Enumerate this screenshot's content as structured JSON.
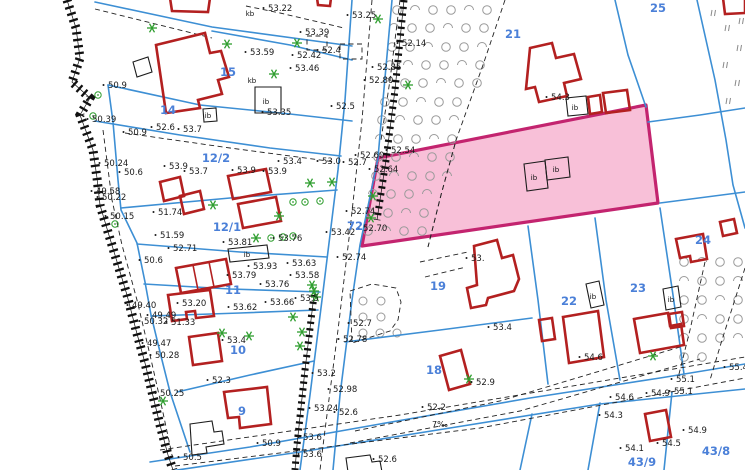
{
  "map": {
    "colors": {
      "background": "#ffffff",
      "boundary": "#3d8fd4",
      "building": "#b32020",
      "black_building": "#1c1c1c",
      "highlight_fill": "#f8bdd6",
      "highlight_border": "#c3246f",
      "parcel_label": "#4b80d8",
      "highlight_label": "#6f74d8",
      "elevation": "#1a1a1a",
      "tree": "#2f9e2f",
      "orchard": "#9a9a9a",
      "meadow": "#8a8a8a",
      "dash": "#222222"
    },
    "highlight_parcel": {
      "number": "20",
      "polygon": "M378,158 L646,105 L658,203 L362,246 Z",
      "inner_dash": "M455,144 L441,195 L428,247"
    },
    "blue_lines": [
      "M95,2 L212,27 L352,46",
      "M212,31 L290,45 L352,60",
      "M108,85 L200,105 L290,114 L352,121",
      "M95,121 L180,135 L270,148 L341,156",
      "M108,85 L113,122 L118,180 L121,210 L137,243 L145,282 L151,315 L160,352 L170,392 L182,428 L190,452",
      "M121,208 L230,198 L337,190",
      "M137,244 L240,252 L327,257",
      "M144,284 L230,289 L320,292",
      "M151,316 L240,313 L318,310",
      "M177,392 L250,375 L314,361",
      "M352,0 L345,100 L338,170 L330,235 L322,300 L310,395 L300,470",
      "M392,0 L383,100 L378,158 L360,245 L352,300 L340,395 L333,470",
      "M615,0 L628,55 L646,107",
      "M697,0 L715,80 L726,140 L733,185 L745,228",
      "M648,122 L700,115 L745,108",
      "M528,226 L538,300 L548,384",
      "M595,218 L606,300 L620,380",
      "M660,208 L673,295 L684,374",
      "M660,203 L745,192",
      "M345,342 L440,330 L532,318",
      "M150,462 L250,447 L380,424 L530,398 L660,378 L745,364",
      "M150,474 L300,452 L450,428 L600,404 L745,389",
      "M600,403 L588,470",
      "M672,392 L664,470",
      "M532,414 L520,470"
    ],
    "dashed_lines": [
      "M246,6 L280,13 L344,28",
      "M95,9 L212,38",
      "M125,133 L230,148 L335,162",
      "M350,291 L372,284 L396,288 L401,302 L398,320 L390,331 L352,343 Z",
      "M455,144 L441,195 L428,247",
      "M160,450 L400,415 L745,357",
      "M175,466 L480,428 L745,378",
      "M355,431 L500,401 L680,347",
      "M350,443 L520,411 L700,359",
      "M705,262 L690,330 L678,378",
      "M745,268 L722,340 L710,380",
      "M420,262 L468,252",
      "M425,277 L466,267",
      "M103,130 L112,200 L122,245 L137,300 L150,355 L162,408 L172,455",
      "M372,0 L362,120 L350,230 L338,330 L325,430 L320,470",
      "M400,0 L390,80 L381,140",
      "M307,36 L327,36 L327,50 L307,50 Z",
      "M340,44 L362,44 L362,59 L340,59 Z",
      "M505,0 L483,65 L455,143"
    ],
    "hatch_bands": [
      {
        "d": "M67,0 L76,28 L80,58 L72,82 L90,98 L80,115 L93,150 L97,178 L100,205 L108,232 L118,265 L127,295 L136,330 L145,363 L152,392 L160,425 L168,455 L173,470",
        "w": 9
      },
      {
        "d": "M404,0 L395,90 L386,160 L377,220",
        "w": 7
      },
      {
        "d": "M314,295 L305,370 L297,445 L295,470",
        "w": 7
      }
    ],
    "red_buildings": [
      "M170,-2 L210,-2 L208,12 L172,11 Z",
      "M317,-2 L331,-2 L330,6 L318,5 Z",
      "M156,45 L205,33 L210,53 L221,51 L229,77 L218,80 L222,94 L198,100 L200,108 L166,113 Z",
      "M228,176 L266,169 L271,192 L233,199 Z",
      "M238,204 L276,197 L281,221 L243,228 Z",
      "M160,182 L180,177 L184,196 L164,201 Z",
      "M180,196 L200,191 L204,209 L184,214 Z",
      "M176,268 L226,259 L231,284 L181,293 Z",
      "M168,295 L210,290 L214,316 L196,318 L195,311 L186,312 L187,319 L172,321 Z",
      "M189,337 L218,333 L222,361 L193,365 Z",
      "M224,392 L267,387 L271,424 L240,428 L239,417 L228,418 Z",
      "M440,356 L461,350 L470,384 L449,390 Z",
      "M474,246 L497,240 L502,258 L513,255 L519,279 L514,291 L488,298 L486,305 L471,308 L467,288 L477,285 Z",
      "M563,317 L598,311 L604,357 L569,363 Z",
      "M539,320 L552,318 L555,339 L542,341 Z",
      "M634,319 L668,313 L670,326 L681,324 L684,345 L640,353 Z",
      "M669,314 L682,312 L684,326 L671,328 Z",
      "M676,239 L703,234 L707,259 L691,262 L690,256 L680,258 Z",
      "M720,222 L734,219 L737,233 L723,236 Z",
      "M530,48 L552,43 L556,58 L574,54 L581,79 L564,83 L567,96 L539,102 L535,87 L526,89 Z",
      "M588,97 L600,95 L602,112 L590,114 Z",
      "M603,93 L627,90 L630,110 L606,113 Z",
      "M723,-2 L745,-2 L745,13 L725,14 Z",
      "M645,414 L666,410 L671,437 L650,441 Z"
    ],
    "red_inner_lines": [
      "M193,265 L198,290",
      "M209,262 L214,287"
    ],
    "black_buildings": [
      "M133,62 L148,57 L152,72 L137,77 Z",
      "M255,87 L281,87 L281,113 L255,113 Z",
      "M203,109 L216,108 L217,121 L204,122 Z",
      "M228,249 L267,245 L269,258 L230,262 Z",
      "M586,284 L599,281 L604,305 L591,308 Z",
      "M663,289 L678,286 L681,307 L666,310 Z",
      "M524,164 L545,161 L548,188 L527,191 Z",
      "M545,160 L568,157 L570,177 L547,180 Z",
      "M566,98 L586,96 L588,114 L568,116 Z",
      "M190,424 L212,421 L214,432 L222,431 L224,444 L206,447 L207,453 L192,455 Z",
      "M346,458 L370,455 L372,462 L380,461 L382,472 L348,472 Z"
    ],
    "parcel_numbers": [
      [
        228,
        76,
        "15"
      ],
      [
        168,
        114,
        "14"
      ],
      [
        216,
        162,
        "12/2"
      ],
      [
        227,
        231,
        "12/1"
      ],
      [
        233,
        294,
        "11"
      ],
      [
        238,
        354,
        "10"
      ],
      [
        242,
        415,
        "9"
      ],
      [
        513,
        38,
        "21"
      ],
      [
        658,
        12,
        "25"
      ],
      [
        355,
        230,
        "72"
      ],
      [
        438,
        290,
        "19"
      ],
      [
        434,
        374,
        "18"
      ],
      [
        569,
        305,
        "22"
      ],
      [
        638,
        292,
        "23"
      ],
      [
        703,
        244,
        "24"
      ],
      [
        716,
        455,
        "43/8"
      ],
      [
        642,
        466,
        "43/9"
      ]
    ],
    "elevations": [
      [
        108,
        85,
        "50.9"
      ],
      [
        92,
        119,
        "50.39"
      ],
      [
        128,
        132,
        "50.9"
      ],
      [
        156,
        127,
        "52.6"
      ],
      [
        183,
        129,
        "53.7"
      ],
      [
        250,
        52,
        "53.59"
      ],
      [
        267,
        112,
        "53.35"
      ],
      [
        268,
        8,
        "53.22"
      ],
      [
        352,
        15,
        "53.25"
      ],
      [
        305,
        32,
        "53.39"
      ],
      [
        297,
        55,
        "52.42"
      ],
      [
        322,
        50,
        "52.4"
      ],
      [
        295,
        68,
        "53.46"
      ],
      [
        377,
        67,
        "52.85"
      ],
      [
        369,
        80,
        "52.80"
      ],
      [
        336,
        106,
        "52.5"
      ],
      [
        402,
        43,
        "52.14"
      ],
      [
        391,
        150,
        "52.54"
      ],
      [
        360,
        155,
        "52.60"
      ],
      [
        374,
        169,
        "52.64"
      ],
      [
        104,
        163,
        "50.24"
      ],
      [
        124,
        172,
        "50.6"
      ],
      [
        96,
        191,
        "49.58"
      ],
      [
        102,
        197,
        "50.22"
      ],
      [
        110,
        216,
        "50.15"
      ],
      [
        144,
        260,
        "50.6"
      ],
      [
        158,
        212,
        "51.74"
      ],
      [
        160,
        235,
        "51.59"
      ],
      [
        173,
        248,
        "52.71"
      ],
      [
        169,
        166,
        "53.9"
      ],
      [
        189,
        171,
        "53.7"
      ],
      [
        237,
        170,
        "53.9"
      ],
      [
        268,
        171,
        "53.9"
      ],
      [
        283,
        161,
        "53.4"
      ],
      [
        322,
        161,
        "53.0"
      ],
      [
        348,
        162,
        "52.7"
      ],
      [
        228,
        242,
        "53.81"
      ],
      [
        278,
        238,
        "53.76"
      ],
      [
        253,
        266,
        "53.93"
      ],
      [
        232,
        275,
        "53.79"
      ],
      [
        292,
        263,
        "53.63"
      ],
      [
        295,
        275,
        "53.58"
      ],
      [
        265,
        284,
        "53.76"
      ],
      [
        351,
        211,
        "52.74"
      ],
      [
        363,
        228,
        "52.70"
      ],
      [
        331,
        232,
        "53.42"
      ],
      [
        342,
        257,
        "52.74"
      ],
      [
        182,
        303,
        "53.20"
      ],
      [
        233,
        307,
        "53.62"
      ],
      [
        270,
        302,
        "53.66"
      ],
      [
        300,
        298,
        "53.5"
      ],
      [
        227,
        340,
        "53.4"
      ],
      [
        212,
        380,
        "52.3"
      ],
      [
        132,
        305,
        "49.40"
      ],
      [
        144,
        321,
        "50.32"
      ],
      [
        152,
        315,
        "49.49"
      ],
      [
        171,
        322,
        "51.33"
      ],
      [
        147,
        343,
        "49.47"
      ],
      [
        155,
        355,
        "50.28"
      ],
      [
        160,
        393,
        "50.25"
      ],
      [
        317,
        373,
        "53.2"
      ],
      [
        333,
        389,
        "52.98"
      ],
      [
        314,
        408,
        "53.24"
      ],
      [
        339,
        412,
        "52.6"
      ],
      [
        303,
        437,
        "53.6"
      ],
      [
        303,
        454,
        "53.6"
      ],
      [
        183,
        457,
        "50.5"
      ],
      [
        262,
        443,
        "50.9"
      ],
      [
        353,
        323,
        "52.7"
      ],
      [
        343,
        339,
        "52.78"
      ],
      [
        493,
        327,
        "53.4"
      ],
      [
        476,
        382,
        "52.9"
      ],
      [
        427,
        407,
        "52.2"
      ],
      [
        378,
        459,
        "52.6"
      ],
      [
        551,
        97,
        "54.3"
      ],
      [
        584,
        357,
        "54.6"
      ],
      [
        471,
        258,
        "53."
      ],
      [
        729,
        367,
        "55.4"
      ],
      [
        676,
        379,
        "55.1"
      ],
      [
        674,
        391,
        "55.1"
      ],
      [
        651,
        393,
        "54.9"
      ],
      [
        615,
        397,
        "54.6"
      ],
      [
        604,
        415,
        "54.3"
      ],
      [
        625,
        448,
        "54.1"
      ],
      [
        662,
        443,
        "54.5"
      ],
      [
        688,
        430,
        "54.9"
      ]
    ],
    "building_tags": [
      [
        266,
        104,
        "ib"
      ],
      [
        247,
        257,
        "ib"
      ],
      [
        593,
        299,
        "ib"
      ],
      [
        671,
        302,
        "ib"
      ],
      [
        534,
        180,
        "ib"
      ],
      [
        556,
        172,
        "ib"
      ],
      [
        575,
        110,
        "ib"
      ],
      [
        208,
        118,
        "ib"
      ],
      [
        250,
        16,
        "kb"
      ],
      [
        252,
        83,
        "kb"
      ]
    ],
    "misc_labels": [
      [
        432,
        427,
        "7‰"
      ]
    ],
    "trees_star": [
      [
        152,
        28
      ],
      [
        227,
        44
      ],
      [
        274,
        74
      ],
      [
        378,
        19
      ],
      [
        297,
        43
      ],
      [
        408,
        85
      ],
      [
        310,
        183
      ],
      [
        332,
        182
      ],
      [
        213,
        205
      ],
      [
        279,
        216
      ],
      [
        256,
        238
      ],
      [
        312,
        285
      ],
      [
        314,
        291
      ],
      [
        316,
        297
      ],
      [
        293,
        317
      ],
      [
        302,
        332
      ],
      [
        300,
        346
      ],
      [
        222,
        333
      ],
      [
        249,
        336
      ],
      [
        163,
        401
      ],
      [
        469,
        379
      ],
      [
        373,
        196
      ],
      [
        371,
        218
      ],
      [
        653,
        356
      ]
    ],
    "trees_circle": [
      [
        98,
        95
      ],
      [
        93,
        116
      ],
      [
        115,
        224
      ],
      [
        293,
        202
      ],
      [
        305,
        202
      ],
      [
        320,
        201
      ],
      [
        271,
        238
      ],
      [
        283,
        237
      ],
      [
        293,
        236
      ]
    ],
    "meadow_ticks": [
      [
        712,
        10
      ],
      [
        740,
        18
      ],
      [
        726,
        25
      ],
      [
        738,
        45
      ],
      [
        724,
        62
      ],
      [
        736,
        80
      ],
      [
        727,
        98
      ]
    ],
    "orchard_main_rows": [
      {
        "y": 10,
        "xs": [
          397,
          415,
          433,
          451,
          469,
          487
        ]
      },
      {
        "y": 28,
        "xs": [
          394,
          412,
          430,
          448,
          466,
          484
        ]
      },
      {
        "y": 47,
        "xs": [
          392,
          410,
          428,
          446,
          464,
          482
        ]
      },
      {
        "y": 65,
        "xs": [
          390,
          408,
          426,
          444,
          462,
          480
        ]
      },
      {
        "y": 83,
        "xs": [
          387,
          405,
          423,
          441,
          459,
          477
        ]
      },
      {
        "y": 102,
        "xs": [
          385,
          403,
          421,
          439,
          457
        ]
      },
      {
        "y": 120,
        "xs": [
          382,
          400,
          418,
          436,
          454
        ]
      },
      {
        "y": 139,
        "xs": [
          380,
          398,
          416,
          434,
          452
        ]
      },
      {
        "y": 157,
        "xs": [
          378,
          396,
          414,
          432,
          450
        ]
      },
      {
        "y": 176,
        "xs": [
          376,
          394,
          412,
          430,
          447
        ]
      },
      {
        "y": 194,
        "xs": [
          373,
          391,
          409,
          427
        ]
      },
      {
        "y": 213,
        "xs": [
          370,
          388,
          406,
          424
        ]
      },
      {
        "y": 231,
        "xs": [
          368,
          386,
          404,
          422
        ]
      }
    ],
    "orchard_se_rows": [
      {
        "y": 262,
        "xs": [
          684,
          702,
          720,
          738
        ]
      },
      {
        "y": 281,
        "xs": [
          684,
          702,
          720,
          738
        ]
      },
      {
        "y": 300,
        "xs": [
          684,
          702,
          720,
          738
        ]
      },
      {
        "y": 319,
        "xs": [
          684,
          702,
          720,
          738
        ]
      },
      {
        "y": 338,
        "xs": [
          684,
          702,
          720,
          738
        ]
      },
      {
        "y": 357,
        "xs": [
          684,
          702
        ]
      }
    ],
    "enclave_circles": [
      [
        363,
        301
      ],
      [
        381,
        301
      ],
      [
        363,
        317
      ],
      [
        381,
        317
      ],
      [
        363,
        333
      ],
      [
        380,
        333
      ],
      [
        397,
        333
      ]
    ]
  }
}
